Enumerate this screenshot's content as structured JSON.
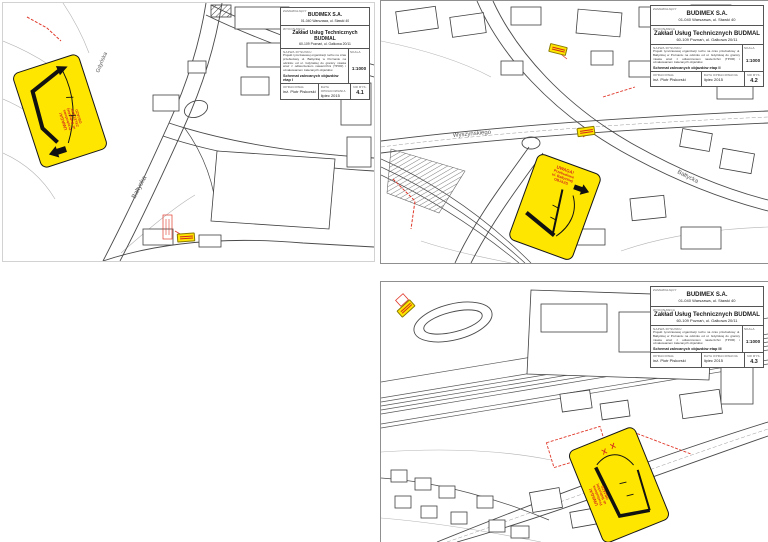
{
  "colors": {
    "sign_yellow": "#ffe600",
    "sign_red": "#d42a1c",
    "detour_red": "#e0392b",
    "map_line": "#4a4a4a"
  },
  "title_block": {
    "client_label": "ZAMAWIAJĄCY",
    "client_name": "BUDIMEX S.A.",
    "client_address": "01-040 Warszawa, ul. Stawki 40",
    "contractor_label": "WYKONAWCA",
    "contractor_name": "Zakład Usług Technicznych BUDMAL",
    "contractor_address": "60-109 Poznań, ul. Gałkowa 20/11",
    "drawing_label": "NAZWA RYSUNKU",
    "scale_label": "SKALA",
    "scale_value": "1:1000",
    "description": "Projekt tymczasowej organizacji ruchu na czas przebudowy ul. Bałtyckiej w Poznaniu na odcinku od ul. Gdyńskiej do granicy miasta wraz z odtworzeniem nawierzchni (TPOR) i oznakowaniem zalecanych objazdów.",
    "author_label": "OPRACOWAŁ",
    "author": "inż. Piotr Piskorski",
    "date_label": "DATA OPRACOWANIA",
    "date": "lipiec 2015",
    "number_label": "NR RYS."
  },
  "sign": {
    "alert": "UWAGA!",
    "line1": "Przebudowa",
    "line2": "ul. Bałtyckiej",
    "line3": "ZALECANY",
    "line4": "OBJAZD"
  },
  "panels": [
    {
      "drawing_no": "4.1",
      "title_bold": "Schemat zalecanych objazdów etap I",
      "streets": [
        "Bałtycka",
        "Gdyńska"
      ]
    },
    {
      "drawing_no": "4.2",
      "title_bold": "Schemat zalecanych objazdów etap II",
      "streets": [
        "Wyszyńskiego",
        "Bałtycka"
      ]
    },
    {
      "drawing_no": "4.3",
      "title_bold": "Schemat zalecanych objazdów etap III",
      "streets": [
        "Bałtycka"
      ]
    }
  ]
}
